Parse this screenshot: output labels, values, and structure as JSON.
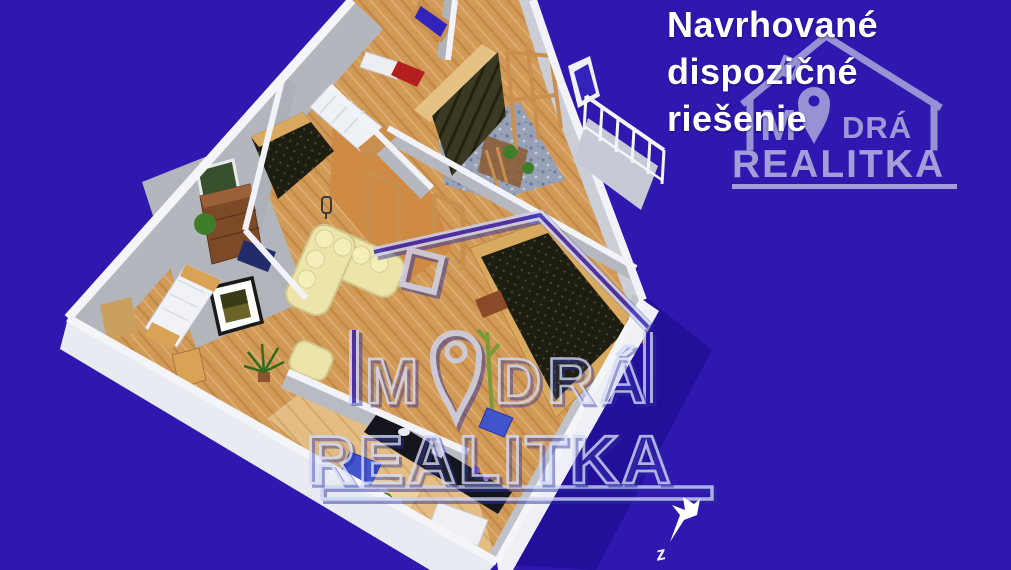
{
  "header": {
    "line1": "Navrhované",
    "line2": "dispozičné",
    "line3": "riešenie"
  },
  "brand": {
    "corner_logo": {
      "word_m": "M",
      "word_dra": "DRÁ",
      "word_realitka": "REALITKA"
    },
    "center_watermark": {
      "word_m": "M",
      "word_dra": "DRÁ",
      "word_realitka": "REALITKA"
    }
  },
  "compass": {
    "label": "z"
  },
  "colors": {
    "background": "#2e18b0",
    "shadow": "#22109a",
    "headline_text": "#ffffff",
    "corner_logo": "#a6a3d8",
    "corner_logo_text": "#b4b1e0",
    "watermark_outline": "#ccd4f2",
    "watermark_dark": "#2b2f9f",
    "wall_white": "#f2f3f8",
    "wall_face_gray": "#b6b8c0",
    "floor_wood": "#d29a57",
    "floor_kitchen": "#e3bd83",
    "floor_hall": "#cf8a44",
    "wood_trim": "#c98f4e",
    "dark_furniture": "#1d1d12",
    "sofa_cream": "#ece4a8",
    "chair_blue": "#4054cc",
    "cabinet_red": "#b31f1f",
    "plant_green": "#3f7d2a"
  },
  "icons": {
    "logo_house": "house-outline",
    "logo_pin": "location-pin",
    "north_arrow": "southwest-dart"
  }
}
